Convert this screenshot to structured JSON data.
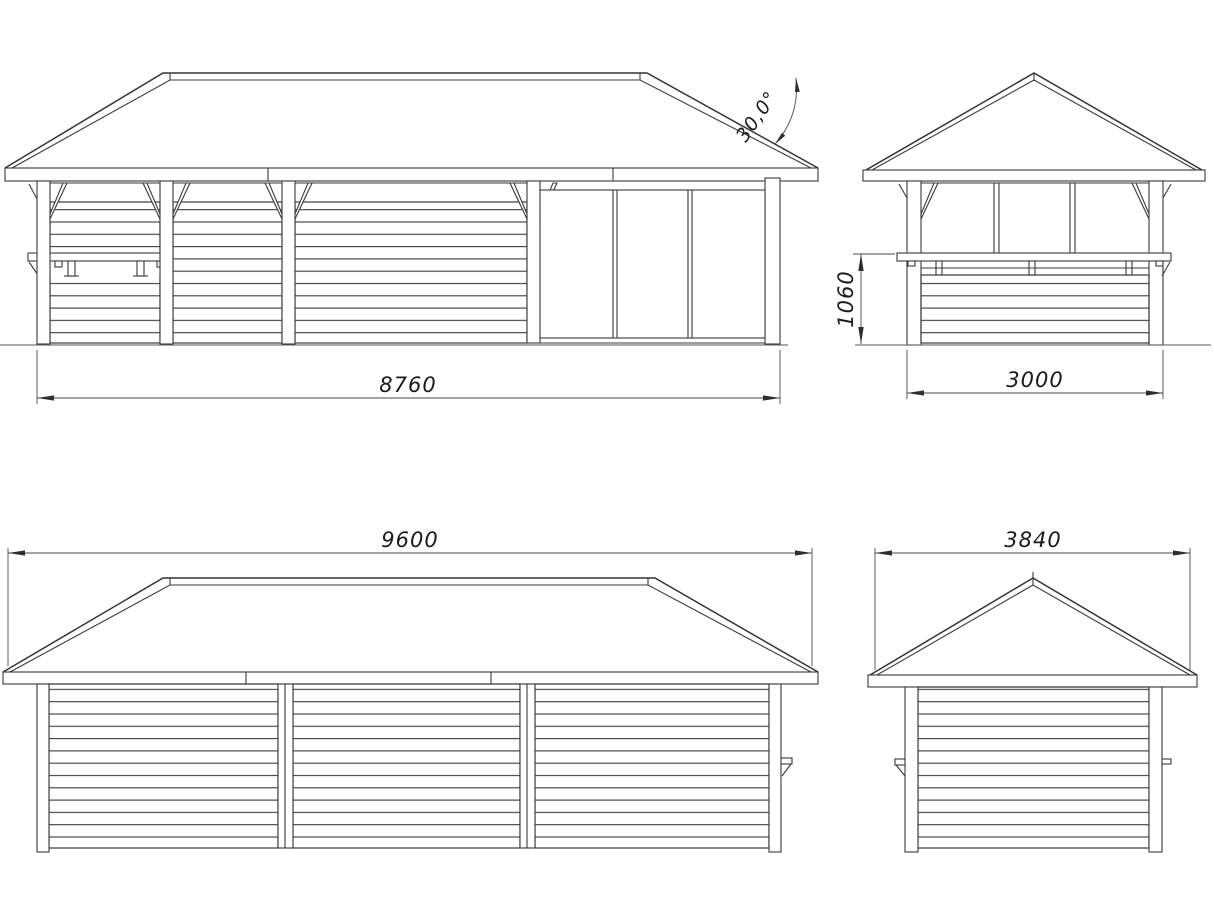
{
  "drawing": {
    "type": "technical-elevation-drawing",
    "subject": "wooden pavilion elevations",
    "views": {
      "front": {
        "width_label": "8760",
        "roof_angle_label": "30,0°"
      },
      "side_a": {
        "width_label": "3000",
        "counter_height_label": "1060"
      },
      "rear": {
        "width_label": "9600"
      },
      "side_b": {
        "width_label": "3840"
      }
    },
    "colors": {
      "background": "#ffffff",
      "line": "#3a3a3a",
      "text": "#1b1b1b"
    }
  }
}
